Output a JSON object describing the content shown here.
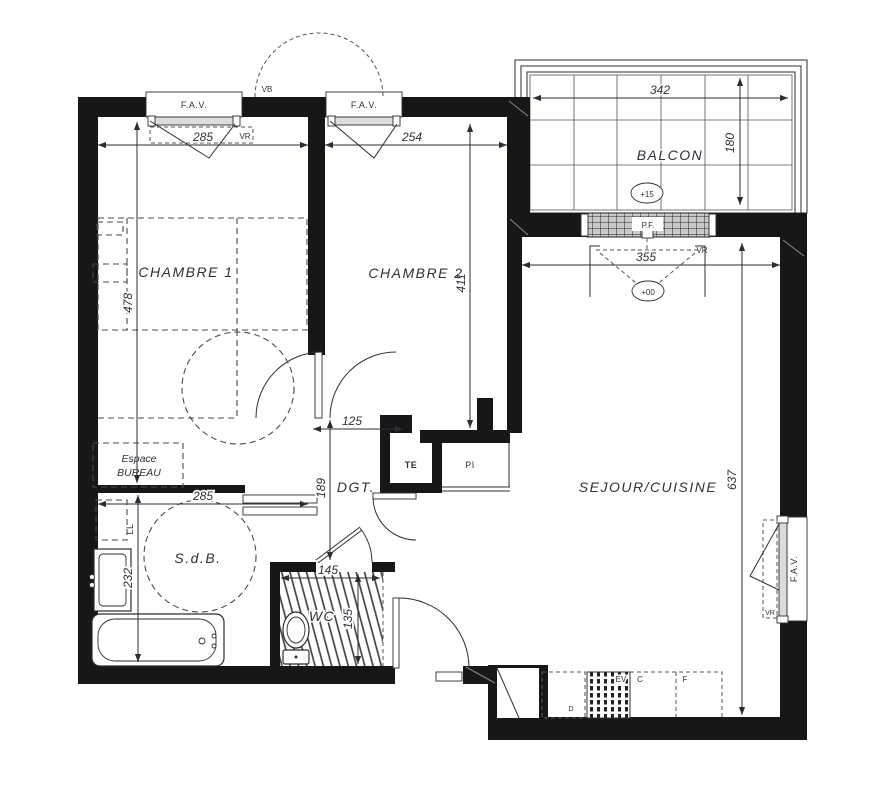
{
  "drawing": {
    "kind": "apartment floor plan"
  },
  "rooms": {
    "chambre1": "CHAMBRE 1",
    "chambre2": "CHAMBRE 2",
    "balcon": "BALCON",
    "sejour_cuisine": "SEJOUR/CUISINE",
    "sdb": "S.d.B.",
    "wc": "WC",
    "dgt": "DGT.",
    "bureau_line1": "Espace",
    "bureau_line2": "BUREAU",
    "te": "TE",
    "pi": "PI"
  },
  "dims": {
    "ch1_w": "285",
    "ch1_h": "478",
    "ch2_w": "254",
    "ch2_h": "411",
    "balc_w": "342",
    "balc_h": "180",
    "bay_w": "355",
    "sej_h": "637",
    "dgt_w": "125",
    "dgt_h": "189",
    "sdb_w": "285",
    "sdb_h": "232",
    "wc_w": "145",
    "wc_h": "135"
  },
  "annotations": {
    "fav": "F.A.V.",
    "vr": "VR",
    "vb": "VB",
    "pf": "P.F.",
    "ll": "LL",
    "ev": "EV",
    "c": "C",
    "f": "F",
    "d": "D",
    "level_balcon": "+15",
    "level_sejour": "+00"
  }
}
